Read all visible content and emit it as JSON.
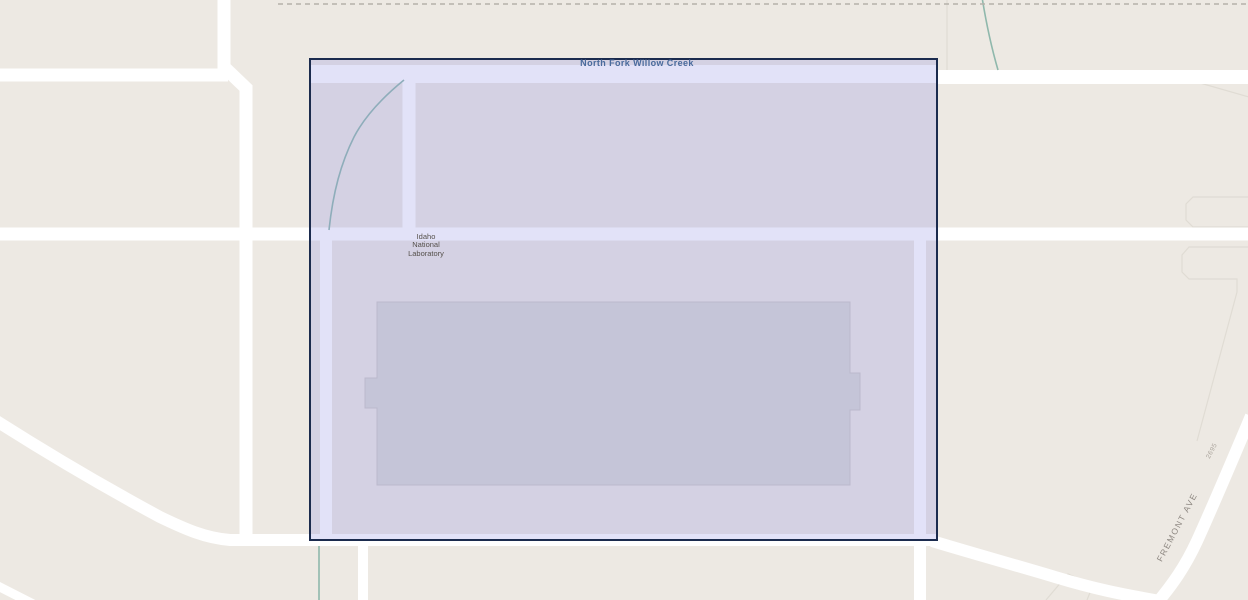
{
  "map": {
    "labels": {
      "creek": "North Fork Willow Creek",
      "facility_lines": [
        "Idaho",
        "National",
        "Laboratory"
      ],
      "street": "FREMONT AVE",
      "address": "2695"
    },
    "colors": {
      "background": "#EDE9E3",
      "road": "#FFFFFF",
      "water_line": "#8FB8AC",
      "building_fill": "#D9D8D4",
      "building_stroke": "#CBC9C4",
      "parcel_line": "#E0DCD4",
      "boundary_dash": "#B5B1AA",
      "selection_fill": "rgba(141,141,227,0.25)",
      "selection_border": "#1B2B4E",
      "creek_label": "#4A6B9D",
      "facility_label": "#55504B",
      "street_label": "#8D8781",
      "address_label": "#ABA59D"
    }
  }
}
